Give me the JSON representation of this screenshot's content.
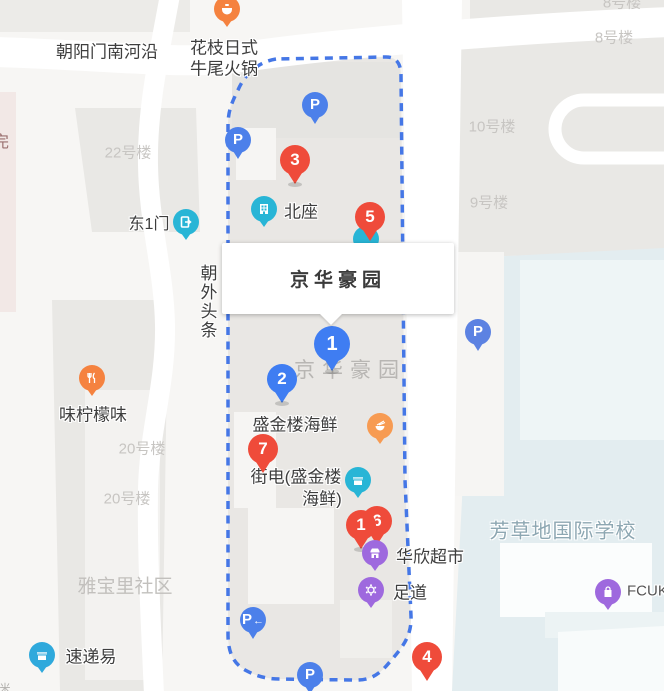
{
  "info_box": {
    "title": "京华豪园"
  },
  "map_labels": {
    "estate": "京华豪园",
    "road_main": "朝阳门南河沿",
    "road_vertical": "朝外头条",
    "partial_left": "完",
    "partial_bottom": "米"
  },
  "building_labels": {
    "b8_partial": "8号楼",
    "b8": "8号楼",
    "b10": "10号楼",
    "b9": "9号楼",
    "b22": "22号楼",
    "b20a": "20号楼",
    "b20b": "20号楼",
    "yabaoli": "雅宝里社区",
    "school": "芳草地国际学校"
  },
  "pois": {
    "hotpot": {
      "line1": "花枝日式",
      "line2": "牛尾火锅"
    },
    "east_gate": {
      "label": "东1门"
    },
    "north_block": {
      "label": "北座"
    },
    "lemon": {
      "label": "味柠檬味"
    },
    "seafood": {
      "label": "盛金楼海鲜"
    },
    "jiedian": {
      "line1": "街电(盛金楼",
      "line2": "海鲜)"
    },
    "huaxin": {
      "label": "华欣超市"
    },
    "zudao": {
      "label": "足道"
    },
    "fcuk": {
      "label": "FCUK"
    },
    "sudiyi": {
      "label": "速递易"
    }
  },
  "markers": {
    "red": [
      {
        "label": "3"
      },
      {
        "label": "5"
      },
      {
        "label": "7"
      },
      {
        "label": "6"
      },
      {
        "label": "1"
      },
      {
        "label": "4"
      }
    ],
    "blue": [
      {
        "label": "1"
      },
      {
        "label": "2"
      }
    ],
    "parking": [
      {
        "label": "P"
      },
      {
        "label": "P"
      },
      {
        "label": "P"
      },
      {
        "label": "P"
      },
      {
        "label": "P"
      }
    ],
    "parking_arrow": "←"
  },
  "colors": {
    "marker_red": "#ef4b3a",
    "marker_blue": "#3f7df2",
    "parking_blue": "#4c80ea",
    "teal": "#28b5d6",
    "orange": "#f5823f",
    "purple": "#9e69de",
    "boundary_blue": "#4577e6",
    "school_bg": "#e3edf0",
    "building_gray": "#e9e7e4"
  }
}
